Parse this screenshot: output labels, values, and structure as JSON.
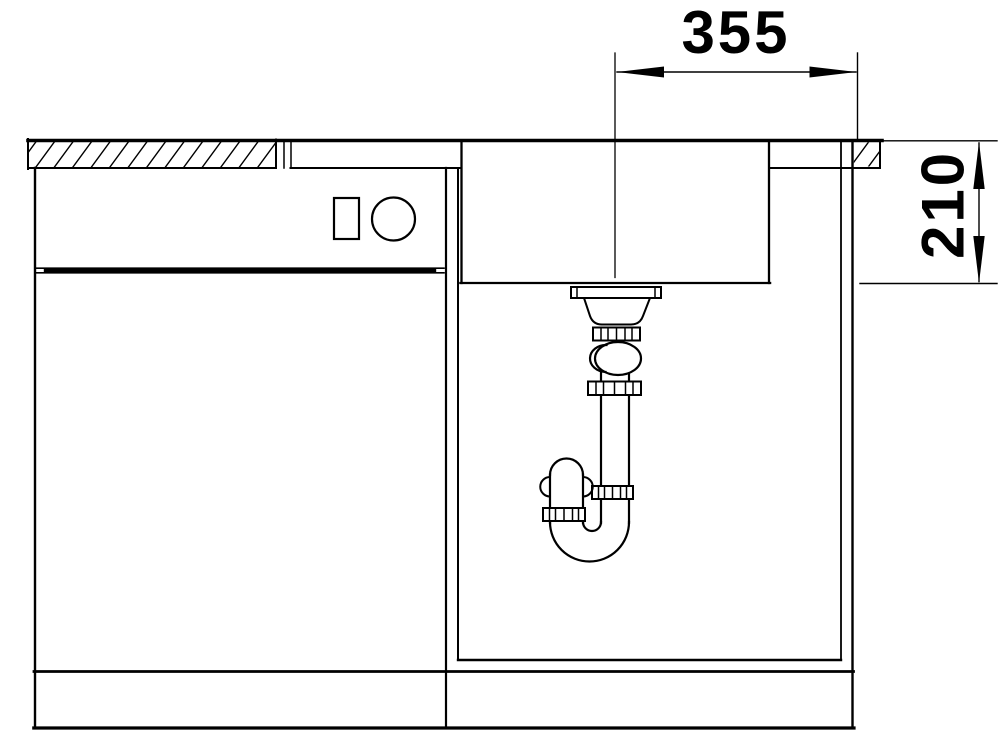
{
  "drawing": {
    "type": "technical-section-drawing",
    "background_color": "#ffffff",
    "line_color": "#000000"
  },
  "dimensions": {
    "width": {
      "label": "355",
      "orientation": "horizontal"
    },
    "depth": {
      "label": "210",
      "orientation": "vertical"
    }
  },
  "components": {
    "countertop": "countertop-with-section-hatch",
    "sink_basin": "sink-basin",
    "drain": "drain-strainer",
    "siphon": "siphon-trap",
    "cabinet_left": "base-cabinet-with-drawer",
    "cabinet_right": "sink-base-cabinet",
    "plinth": "plinth"
  }
}
